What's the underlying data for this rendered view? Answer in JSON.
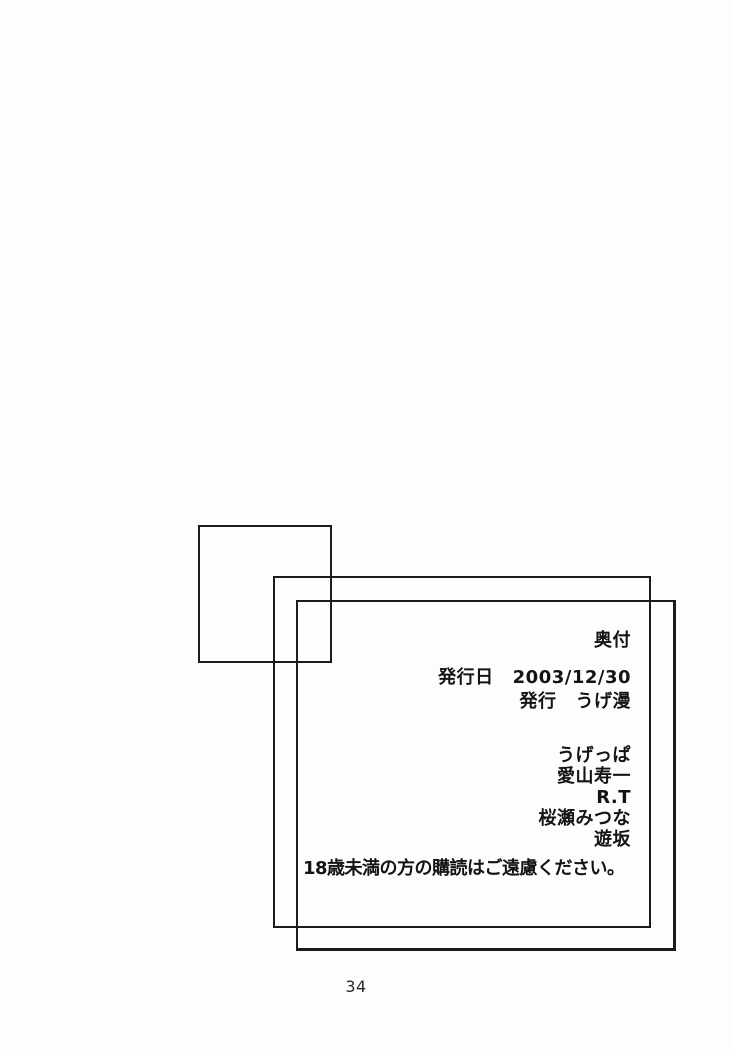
{
  "colophon": {
    "title": "奥付",
    "publication": [
      {
        "label": "発行日",
        "value": "2003/12/30"
      },
      {
        "label": "発行",
        "value": "うげ漫"
      }
    ],
    "credits": [
      "うげっぱ",
      "愛山寿一",
      "R.T",
      "桜瀬みつな",
      "遊坂"
    ],
    "notice": "18歳未満の方の購読はご遠慮ください。"
  },
  "page": {
    "number": "34"
  }
}
